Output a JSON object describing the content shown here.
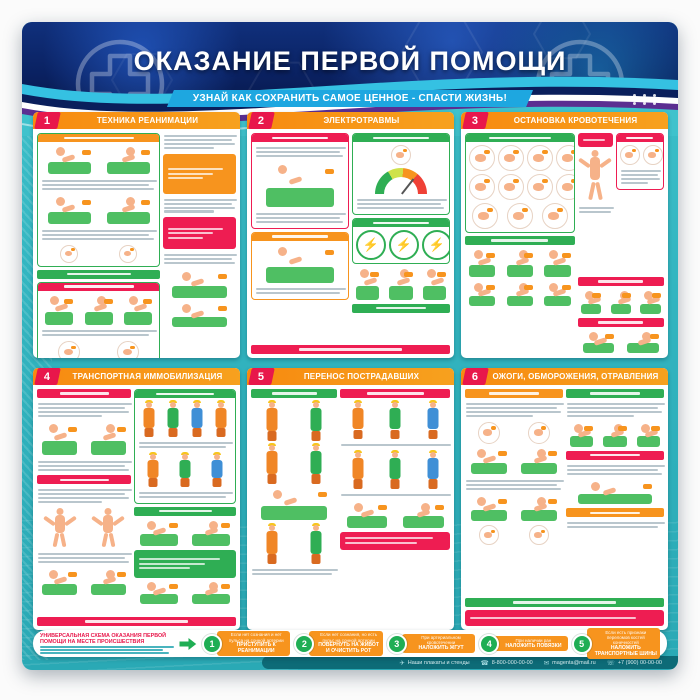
{
  "poster": {
    "title": "ОКАЗАНИЕ ПЕРВОЙ ПОМОЩИ",
    "subtitle": "УЗНАЙ КАК СОХРАНИТЬ САМОЕ ЦЕННОЕ - СПАСТИ ЖИЗНЬ!"
  },
  "colors": {
    "header_navy": "#0c2a6e",
    "teal_background": "#35b9c3",
    "panel_header_orange": "#f7941e",
    "number_badge_red": "#e8174b",
    "green": "#2fae54",
    "ribbon_blue": "#1ea7e0",
    "swoosh_purple": "#5b2e91"
  },
  "panels": [
    {
      "number": "1",
      "title": "ТЕХНИКА РЕАНИМАЦИИ",
      "layout": [
        {
          "t": "cols",
          "w": [
            63,
            37
          ],
          "cols": [
            [
              {
                "t": "box",
                "b": "#2fae54",
                "h": "#f7941e",
                "k": [
                  {
                    "t": "figs",
                    "k": "scene",
                    "n": 2,
                    "hh": 30
                  },
                  {
                    "t": "lines",
                    "n": 3
                  },
                  {
                    "t": "figs",
                    "k": "scene",
                    "n": 2,
                    "hh": 30
                  },
                  {
                    "t": "lines",
                    "n": 3
                  },
                  {
                    "t": "figs",
                    "k": "circle",
                    "n": 2,
                    "hh": 16
                  }
                ]
              },
              {
                "t": "bar",
                "c": "#2fae54"
              },
              {
                "t": "box",
                "b": "#2fae54",
                "h": "#ee1d52",
                "k": [
                  {
                    "t": "figs",
                    "k": "scene",
                    "n": 3,
                    "hh": 32
                  },
                  {
                    "t": "lines",
                    "n": 2
                  },
                  {
                    "t": "figs",
                    "k": "circle",
                    "n": 2,
                    "hh": 20
                  }
                ]
              }
            ],
            [
              {
                "t": "lines",
                "n": 4
              },
              {
                "t": "note",
                "c": "#f7941e",
                "hh": 34
              },
              {
                "t": "lines",
                "n": 4
              },
              {
                "t": "note",
                "c": "#ee1d52",
                "hh": 26
              },
              {
                "t": "lines",
                "n": 3
              },
              {
                "t": "figs",
                "k": "scene",
                "n": 1,
                "hh": 30
              },
              {
                "t": "figs",
                "k": "scene",
                "n": 1,
                "hh": 26
              }
            ]
          ]
        }
      ]
    },
    {
      "number": "2",
      "title": "ЭЛЕКТРОТРАВМЫ",
      "layout": [
        {
          "t": "cols",
          "w": [
            50,
            50
          ],
          "cols": [
            [
              {
                "t": "box",
                "b": "#ee1d52",
                "h": "#ee1d52",
                "k": [
                  {
                    "t": "lines",
                    "n": 3
                  },
                  {
                    "t": "figs",
                    "k": "scene",
                    "n": 1,
                    "hh": 46
                  },
                  {
                    "t": "lines",
                    "n": 3
                  }
                ]
              },
              {
                "t": "box",
                "b": "#f7941e",
                "h": "#f7941e",
                "k": [
                  {
                    "t": "figs",
                    "k": "scene",
                    "n": 1,
                    "hh": 40
                  },
                  {
                    "t": "lines",
                    "n": 2
                  }
                ]
              }
            ],
            [
              {
                "t": "box",
                "b": "#2fae54",
                "h": "#2fae54",
                "k": [
                  {
                    "t": "figs",
                    "k": "circle",
                    "n": 1,
                    "hh": 18
                  },
                  {
                    "t": "figs",
                    "k": "gauge",
                    "n": 1,
                    "hh": 26
                  },
                  {
                    "t": "lines",
                    "n": 3
                  }
                ]
              },
              {
                "t": "box",
                "b": "#2fae54",
                "h": "#2fae54",
                "k": [
                  {
                    "t": "figs",
                    "k": "bolt",
                    "n": 3,
                    "hh": 26
                  }
                ]
              },
              {
                "t": "figs",
                "k": "scene",
                "n": 3,
                "hh": 34
              },
              {
                "t": "bar",
                "c": "#2fae54"
              }
            ]
          ]
        },
        {
          "t": "bar",
          "c": "#ee1d52"
        }
      ]
    },
    {
      "number": "3",
      "title": "ОСТАНОВКА КРОВОТЕЧЕНИЯ",
      "layout": [
        {
          "t": "cols",
          "w": [
            56,
            44
          ],
          "cols": [
            [
              {
                "t": "box",
                "b": "#2fae54",
                "h": "#2fae54",
                "k": [
                  {
                    "t": "figs",
                    "k": "circle",
                    "n": 4,
                    "hh": 24
                  },
                  {
                    "t": "figs",
                    "k": "circle",
                    "n": 4,
                    "hh": 24
                  },
                  {
                    "t": "figs",
                    "k": "circle",
                    "n": 3,
                    "hh": 24
                  }
                ]
              },
              {
                "t": "bar",
                "c": "#2fae54"
              },
              {
                "t": "figs",
                "k": "scene",
                "n": 3,
                "hh": 30
              },
              {
                "t": "figs",
                "k": "scene",
                "n": 3,
                "hh": 26
              }
            ],
            [
              {
                "t": "cols",
                "w": [
                  42,
                  58
                ],
                "cols": [
                  [
                    {
                      "t": "note",
                      "c": "#ee1d52",
                      "hh": 8
                    },
                    {
                      "t": "figs",
                      "k": "body",
                      "n": 1,
                      "hh": 52
                    },
                    {
                      "t": "lines",
                      "n": 2
                    }
                  ],
                  [
                    {
                      "t": "box",
                      "b": "#ee1d52",
                      "h": "#ee1d52",
                      "k": [
                        {
                          "t": "figs",
                          "k": "circle",
                          "n": 2,
                          "hh": 18
                        },
                        {
                          "t": "lines",
                          "n": 4
                        }
                      ]
                    }
                  ]
                ]
              },
              {
                "t": "bar",
                "c": "#ee1d52"
              },
              {
                "t": "figs",
                "k": "scene",
                "n": 3,
                "hh": 26
              },
              {
                "t": "bar",
                "c": "#ee1d52"
              },
              {
                "t": "figs",
                "k": "scene",
                "n": 2,
                "hh": 24
              }
            ]
          ]
        }
      ]
    },
    {
      "number": "4",
      "title": "ТРАНСПОРТНАЯ ИММОБИЛИЗАЦИЯ",
      "layout": [
        {
          "t": "cols",
          "w": [
            48,
            52
          ],
          "cols": [
            [
              {
                "t": "bar",
                "c": "#ee1d52"
              },
              {
                "t": "lines",
                "n": 4
              },
              {
                "t": "figs",
                "k": "scene",
                "n": 2,
                "hh": 34
              },
              {
                "t": "lines",
                "n": 3
              },
              {
                "t": "bar",
                "c": "#ee1d52"
              },
              {
                "t": "lines",
                "n": 4
              },
              {
                "t": "figs",
                "k": "body",
                "n": 2,
                "hh": 40
              },
              {
                "t": "lines",
                "n": 3
              },
              {
                "t": "figs",
                "k": "scene",
                "n": 2,
                "hh": 28
              }
            ],
            [
              {
                "t": "box",
                "b": "#2fae54",
                "h": "#2fae54",
                "k": [
                  {
                    "t": "figs",
                    "k": "person",
                    "n": 4,
                    "hh": 36
                  },
                  {
                    "t": "lines",
                    "n": 2
                  },
                  {
                    "t": "figs",
                    "k": "person",
                    "n": 3,
                    "hh": 34
                  },
                  {
                    "t": "lines",
                    "n": 2
                  }
                ]
              },
              {
                "t": "bar",
                "c": "#2fae54"
              },
              {
                "t": "figs",
                "k": "scene",
                "n": 2,
                "hh": 28
              },
              {
                "t": "note",
                "c": "#2fae54",
                "hh": 22
              },
              {
                "t": "figs",
                "k": "scene",
                "n": 2,
                "hh": 24
              }
            ]
          ]
        },
        {
          "t": "bar",
          "c": "#ee1d52"
        }
      ]
    },
    {
      "number": "5",
      "title": "ПЕРЕНОС ПОСТРАДАВШИХ",
      "layout": [
        {
          "t": "cols",
          "w": [
            44,
            56
          ],
          "cols": [
            [
              {
                "t": "bar",
                "c": "#2fae54"
              },
              {
                "t": "figs",
                "k": "person",
                "n": 2,
                "hh": 40
              },
              {
                "t": "figs",
                "k": "person",
                "n": 2,
                "hh": 40
              },
              {
                "t": "figs",
                "k": "scene",
                "n": 1,
                "hh": 34
              },
              {
                "t": "figs",
                "k": "person",
                "n": 2,
                "hh": 40
              },
              {
                "t": "lines",
                "n": 2
              }
            ],
            [
              {
                "t": "bar",
                "c": "#ee1d52"
              },
              {
                "t": "figs",
                "k": "person",
                "n": 3,
                "hh": 38
              },
              {
                "t": "lines",
                "n": 1
              },
              {
                "t": "figs",
                "k": "person",
                "n": 3,
                "hh": 38
              },
              {
                "t": "lines",
                "n": 1
              },
              {
                "t": "figs",
                "k": "scene",
                "n": 2,
                "hh": 28
              },
              {
                "t": "note",
                "c": "#ee1d52",
                "hh": 12
              }
            ]
          ]
        }
      ]
    },
    {
      "number": "6",
      "title": "ОЖОГИ, ОБМОРОЖЕНИЯ, ОТРАВЛЕНИЯ",
      "layout": [
        {
          "t": "cols",
          "w": [
            50,
            50
          ],
          "cols": [
            [
              {
                "t": "bar",
                "c": "#f7941e"
              },
              {
                "t": "lines",
                "n": 4
              },
              {
                "t": "figs",
                "k": "circle",
                "n": 2,
                "hh": 20
              },
              {
                "t": "figs",
                "k": "scene",
                "n": 2,
                "hh": 28
              },
              {
                "t": "lines",
                "n": 3
              },
              {
                "t": "figs",
                "k": "scene",
                "n": 2,
                "hh": 28
              },
              {
                "t": "figs",
                "k": "circle",
                "n": 2,
                "hh": 18
              }
            ],
            [
              {
                "t": "bar",
                "c": "#2fae54"
              },
              {
                "t": "lines",
                "n": 4
              },
              {
                "t": "figs",
                "k": "scene",
                "n": 3,
                "hh": 26
              },
              {
                "t": "bar",
                "c": "#ee1d52"
              },
              {
                "t": "lines",
                "n": 3
              },
              {
                "t": "figs",
                "k": "scene",
                "n": 1,
                "hh": 26
              },
              {
                "t": "bar",
                "c": "#f7941e"
              },
              {
                "t": "lines",
                "n": 2
              }
            ]
          ]
        },
        {
          "t": "bar",
          "c": "#2fae54"
        },
        {
          "t": "note",
          "c": "#ee1d52",
          "hh": 10
        }
      ]
    }
  ],
  "scheme": {
    "title": "УНИВЕРСАЛЬНАЯ СХЕМА ОКАЗАНИЯ ПЕРВОЙ ПОМОЩИ НА МЕСТЕ ПРОИСШЕСТВИЯ",
    "steps": [
      {
        "num": "1",
        "condition": "Если нет сознания и нет пульса на сонной артерии",
        "action": "ПРИСТУПИТЬ К РЕАНИМАЦИИ"
      },
      {
        "num": "2",
        "condition": "Если нет сознания, но есть пульс на сонной артерии",
        "action": "ПОВЕРНУТЬ НА ЖИВОТ И ОЧИСТИТЬ РОТ"
      },
      {
        "num": "3",
        "condition": "При артериальном кровотечении",
        "action": "НАЛОЖИТЬ ЖГУТ"
      },
      {
        "num": "4",
        "condition": "При наличии ран",
        "action": "НАЛОЖИТЬ ПОВЯЗКИ"
      },
      {
        "num": "5",
        "condition": "Если есть признаки переломов костей конечностей",
        "action": "НАЛОЖИТЬ ТРАНСПОРТНЫЕ ШИНЫ"
      }
    ]
  },
  "footer": {
    "items": [
      {
        "icon": "plane-icon",
        "text": "Наши плакаты и стенды"
      },
      {
        "icon": "phone-icon",
        "text": "8-800-000-00-00"
      },
      {
        "icon": "email-icon",
        "text": "magenta@mail.ru"
      },
      {
        "icon": "handset-icon",
        "text": "+7 (900) 00-00-00"
      }
    ]
  }
}
